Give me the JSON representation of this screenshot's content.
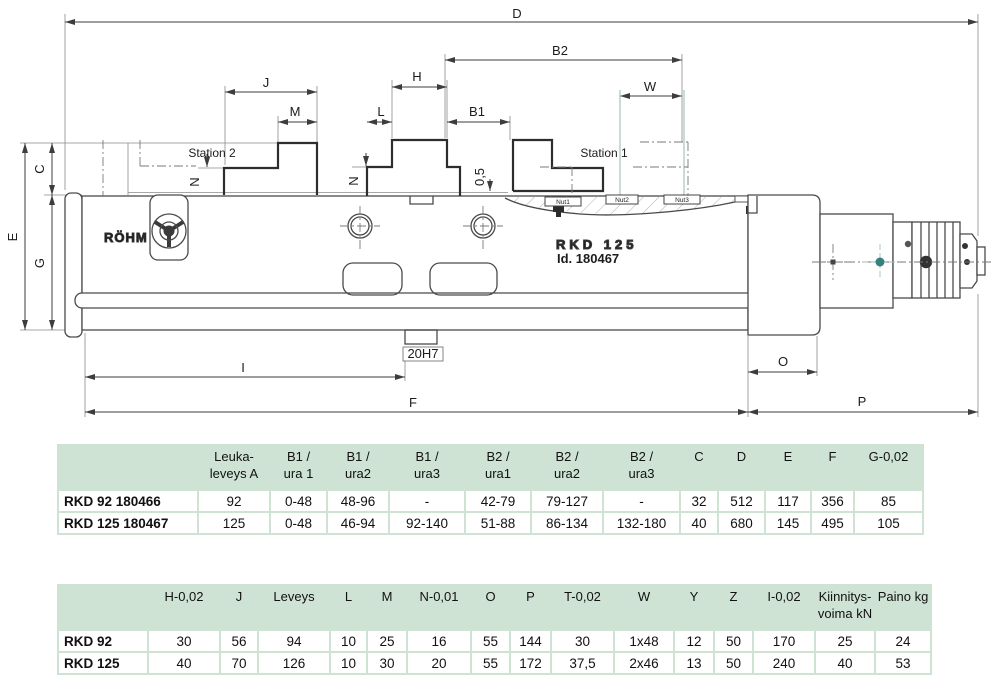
{
  "drawing": {
    "labels": {
      "d": "D",
      "b2": "B2",
      "j": "J",
      "h": "H",
      "w": "W",
      "m": "M",
      "l": "L",
      "b1": "B1",
      "c": "C",
      "e": "E",
      "g": "G",
      "n_left": "N",
      "n_center": "N",
      "offset": "0,5",
      "keyway": "20H7",
      "i": "I",
      "f": "F",
      "o": "O",
      "p": "P"
    },
    "station_1": "Station 1",
    "station_2": "Station 2",
    "nut_1": "Nut1",
    "nut_2": "Nut2",
    "nut_3": "Nut3",
    "logo": "RÖHM",
    "model_marking": "RKD 125",
    "id_marking": "Id. 180467"
  },
  "table1": {
    "headers": [
      "",
      "Leuka-\nleveys A",
      "B1 /\nura 1",
      "B1 /\nura2",
      "B1 /\nura3",
      "B2 /\nura1",
      "B2 /\nura2",
      "B2 /\nura3",
      "C",
      "D",
      "E",
      "F",
      "G-0,02"
    ],
    "rows": [
      {
        "label": "RKD 92 180466",
        "cells": [
          "92",
          "0-48",
          "48-96",
          "-",
          "42-79",
          "79-127",
          "-",
          "32",
          "512",
          "117",
          "356",
          "85"
        ]
      },
      {
        "label": "RKD 125 180467",
        "cells": [
          "125",
          "0-48",
          "46-94",
          "92-140",
          "51-88",
          "86-134",
          "132-180",
          "40",
          "680",
          "145",
          "495",
          "105"
        ]
      }
    ]
  },
  "table2": {
    "headers": [
      "",
      "H-0,02",
      "J",
      "Leveys",
      "L",
      "M",
      "N-0,01",
      "O",
      "P",
      "T-0,02",
      "W",
      "Y",
      "Z",
      "I-0,02",
      "Kiinnitys-\nvoima kN",
      "Paino kg"
    ],
    "rows": [
      {
        "label": "RKD 92",
        "cells": [
          "30",
          "56",
          "94",
          "10",
          "25",
          "16",
          "55",
          "144",
          "30",
          "1x48",
          "12",
          "50",
          "170",
          "25",
          "24"
        ]
      },
      {
        "label": "RKD 125",
        "cells": [
          "40",
          "70",
          "126",
          "10",
          "30",
          "20",
          "55",
          "172",
          "37,5",
          "2x46",
          "13",
          "50",
          "240",
          "40",
          "53"
        ]
      }
    ]
  },
  "colors": {
    "table_green": "#cfe3d5",
    "line_dark": "#3d3d3d",
    "teal_accent": "#9fbebb"
  }
}
